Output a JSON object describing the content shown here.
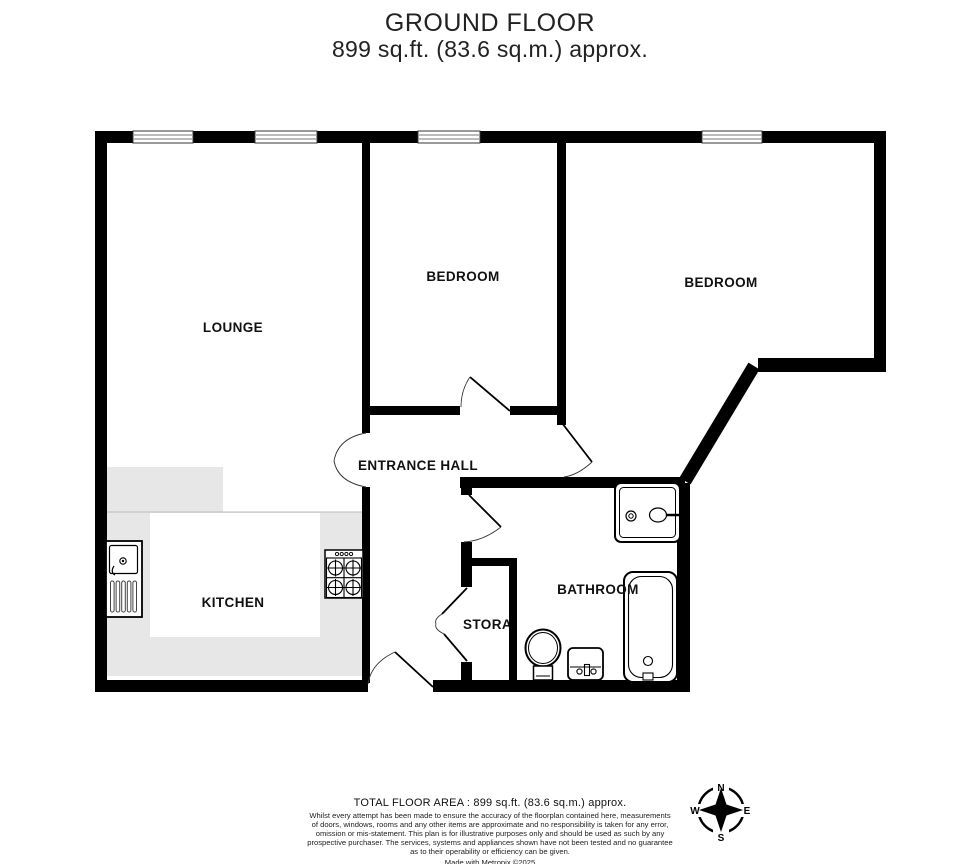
{
  "title": {
    "line1": "GROUND FLOOR",
    "line2": "899 sq.ft. (83.6 sq.m.) approx."
  },
  "rooms": {
    "lounge": "LOUNGE",
    "bedroom1": "BEDROOM",
    "bedroom2": "BEDROOM",
    "entrance_hall": "ENTRANCE HALL",
    "kitchen": "KITCHEN",
    "bathroom": "BATHROOM",
    "storage": "STORAGE"
  },
  "compass": {
    "north": "N",
    "east": "E",
    "south": "S",
    "west": "W"
  },
  "footer": {
    "total_area": "TOTAL FLOOR AREA : 899 sq.ft. (83.6 sq.m.) approx.",
    "disclaimer_lines": [
      "Whilst every attempt has been made to ensure the accuracy of the floorplan contained here, measurements",
      "of doors, windows, rooms and any other items are approximate and no responsibility is taken for any error,",
      "omission or mis-statement. This plan is for illustrative purposes only and should be used as such by any",
      "prospective purchaser. The services, systems and appliances shown have not been tested and no guarantee",
      "as to their operability or efficiency can be given.",
      "Made with Metropix ©2025"
    ]
  },
  "colors": {
    "wall": "#000000",
    "counter": "#e7e7e7",
    "text": "#111111",
    "background": "#ffffff"
  }
}
